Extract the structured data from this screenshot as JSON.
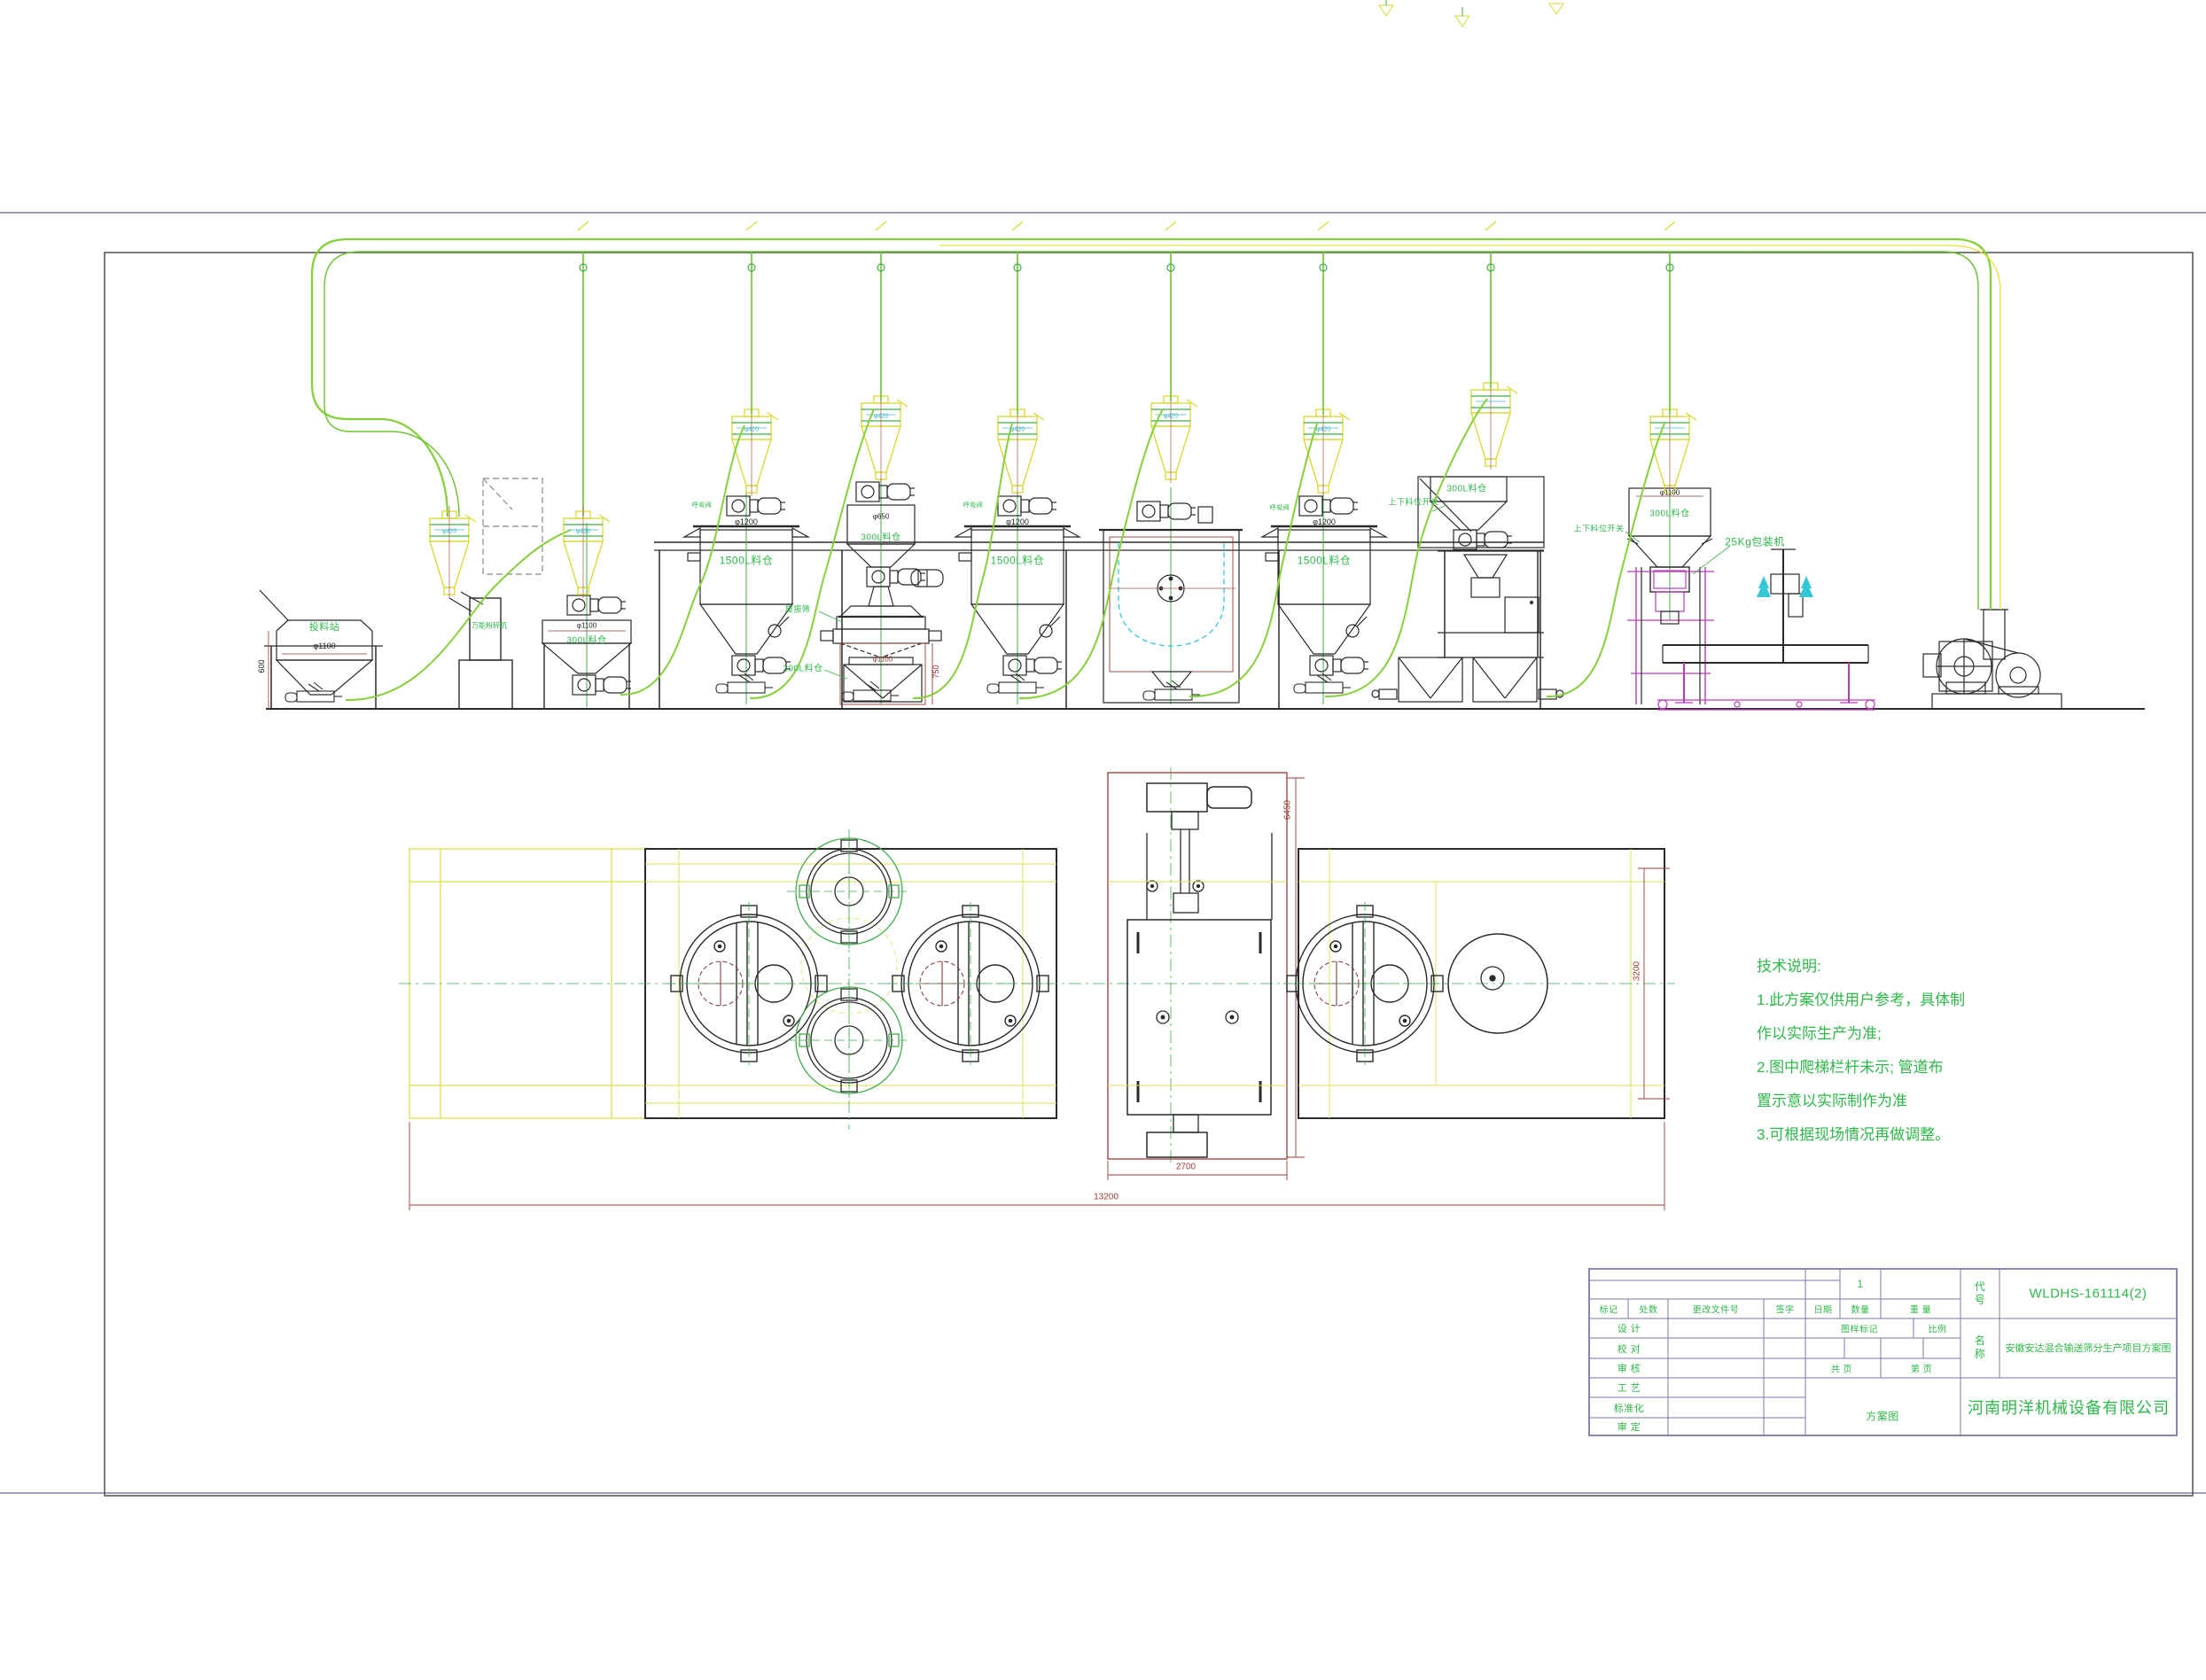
{
  "notes": {
    "title": "技术说明:",
    "line1": "1.此方案仅供用户参考，具体制",
    "line2": "作以实际生产为准;",
    "line3": "2.图中爬梯栏杆未示; 管道布",
    "line4": "置示意以实际制作为准",
    "line5": "3.可根据现场情况再做调整。"
  },
  "labels": {
    "feed_station": "投料站",
    "pulverizer": "万能粉碎机",
    "silo_300": "300L料仓",
    "silo_1500": "1500L料仓",
    "silo_200": "200L料仓",
    "sieve": "旋振筛",
    "breather": "呼吸阀",
    "level_switch": "上下料位开关",
    "packer_25kg": "25Kg包装机"
  },
  "dims": {
    "phi1100": "φ1100",
    "phi1200": "φ1200",
    "phi650": "φ650",
    "phi420": "φ420",
    "h750": "750",
    "h600": "600",
    "w2700": "2700",
    "w13200": "13200",
    "h3200": "3200",
    "h6450": "6450"
  },
  "titleblock": {
    "qty_value": "1",
    "col_mark": "标记",
    "col_count": "处数",
    "col_doc": "更改文件号",
    "col_sign": "签字",
    "col_date": "日期",
    "col_qty": "数量",
    "col_weight": "重  量",
    "row_design": "设  计",
    "row_proof": "校  对",
    "row_audit": "审  核",
    "row_craft": "工  艺",
    "row_standard": "标准化",
    "row_approve": "审  定",
    "stamp": "图样标记",
    "scale": "比例",
    "total_pages": "共    页",
    "page_no": "第    页",
    "doc_type": "方案图",
    "code_label": "代\n号",
    "code": "WLDHS-161114(2)",
    "name_label": "名\n称",
    "name": "安徽安达混合输送筛分生产项目方案图",
    "company": "河南明洋机械设备有限公司"
  }
}
